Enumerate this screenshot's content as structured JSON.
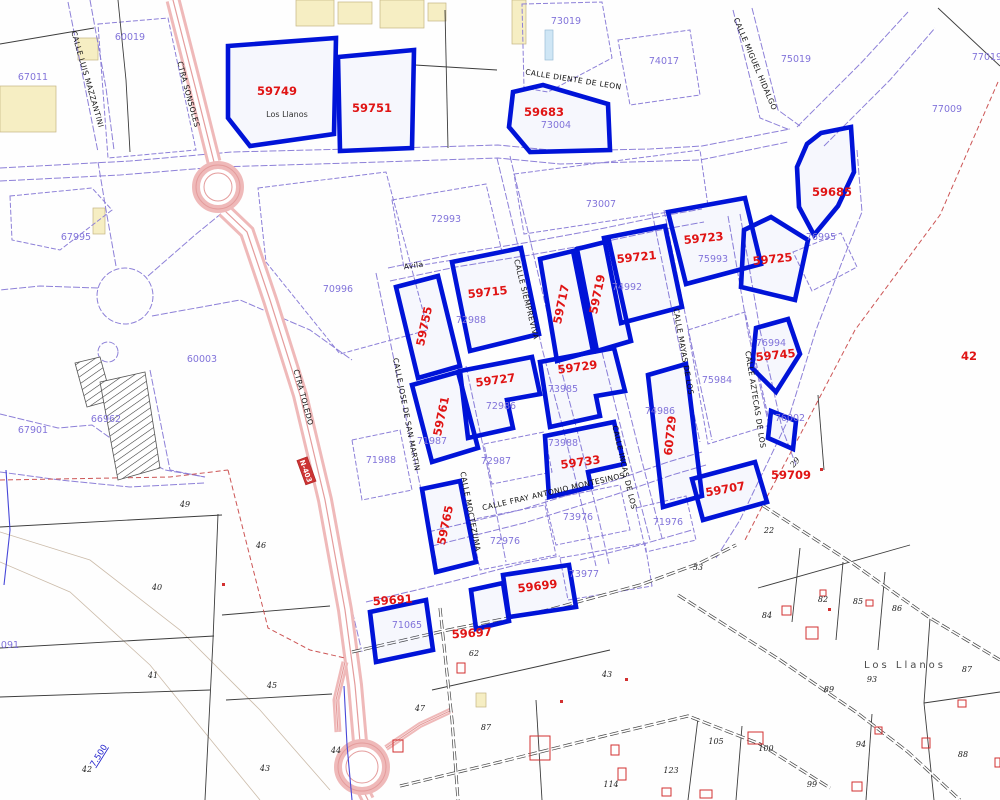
{
  "map": {
    "colors": {
      "highlight_blue": "#0013d8",
      "label_red": "#e01414",
      "parcel_purple": "#8274da",
      "road_pink": "#f0bcbc",
      "street_text": "#101010"
    },
    "parcels": [
      {
        "id": "59749",
        "lx": 277,
        "ly": 95,
        "rot": 0,
        "pts": "228,46 336,38 334,134 250,146 228,118"
      },
      {
        "id": "59751",
        "lx": 372,
        "ly": 112,
        "rot": 0,
        "pts": "338,57 414,50 412,148 340,151"
      },
      {
        "id": "59683",
        "lx": 544,
        "ly": 116,
        "rot": 0,
        "pts": "513,92 543,85 608,104 610,150 530,152 509,127"
      },
      {
        "id": "59685",
        "lx": 832,
        "ly": 196,
        "rot": 0,
        "pts": "821,133 851,127 854,172 838,206 814,235 799,207 797,167 807,144"
      },
      {
        "id": "59723",
        "lx": 704,
        "ly": 242,
        "rot": -6,
        "pts": "668,212 745,198 761,264 686,284"
      },
      {
        "id": "59721",
        "lx": 637,
        "ly": 261,
        "rot": -6,
        "pts": "604,238 665,226 682,307 621,323"
      },
      {
        "id": "59725",
        "lx": 773,
        "ly": 263,
        "rot": -6,
        "pts": "744,230 771,217 808,240 795,300 741,287"
      },
      {
        "id": "59715",
        "lx": 488,
        "ly": 296,
        "rot": -6,
        "pts": "452,262 521,248 539,334 470,351"
      },
      {
        "id": "59717",
        "lx": 565,
        "ly": 305,
        "rot": -78,
        "pts": "540,259 573,251 593,351 557,361"
      },
      {
        "id": "59719",
        "lx": 601,
        "ly": 295,
        "rot": -78,
        "pts": "577,249 609,241 631,341 597,351"
      },
      {
        "id": "59755",
        "lx": 428,
        "ly": 327,
        "rot": -78,
        "pts": "396,287 438,276 460,366 418,378"
      },
      {
        "id": "59761",
        "lx": 445,
        "ly": 417,
        "rot": -78,
        "pts": "412,385 458,372 478,448 432,462"
      },
      {
        "id": "59727",
        "lx": 496,
        "ly": 384,
        "rot": -8,
        "pts": "460,371 532,357 540,394 507,400 513,428 468,438"
      },
      {
        "id": "59729",
        "lx": 578,
        "ly": 371,
        "rot": -8,
        "pts": "540,362 614,348 625,391 596,396 600,416 550,427"
      },
      {
        "id": "59733",
        "lx": 581,
        "ly": 466,
        "rot": -8,
        "pts": "545,436 614,422 624,464 588,472 591,487 549,497"
      },
      {
        "id": "60729",
        "lx": 674,
        "ly": 436,
        "rot": -84,
        "pts": "648,375 686,364 702,496 663,507"
      },
      {
        "id": "59745",
        "lx": 776,
        "ly": 359,
        "rot": -6,
        "pts": "756,328 788,319 800,354 776,392 752,368"
      },
      {
        "id": "59709",
        "lx": 791,
        "ly": 479,
        "rot": 0,
        "pts": "771,411 796,421 793,449 768,438"
      },
      {
        "id": "59707",
        "lx": 726,
        "ly": 493,
        "rot": -10,
        "pts": "692,479 755,462 767,502 703,520"
      },
      {
        "id": "59765",
        "lx": 449,
        "ly": 526,
        "rot": -78,
        "pts": "422,489 460,481 476,562 436,572"
      },
      {
        "id": "59691",
        "lx": 393,
        "ly": 604,
        "rot": -4,
        "pts": "370,612 426,600 433,650 376,662"
      },
      {
        "id": "",
        "lx": 0,
        "ly": 0,
        "rot": 0,
        "pts": "471,590 503,583 509,621 476,629"
      },
      {
        "id": "59699",
        "lx": 538,
        "ly": 590,
        "rot": -7,
        "pts": "503,575 569,565 576,607 509,617"
      }
    ],
    "red_labels": [
      {
        "t": "59697",
        "x": 472,
        "y": 637,
        "r": -4
      },
      {
        "t": "42",
        "x": 969,
        "y": 360,
        "r": 0
      }
    ],
    "parcel_numbers": [
      {
        "t": "60019",
        "x": 130,
        "y": 40
      },
      {
        "t": "67011",
        "x": 33,
        "y": 80
      },
      {
        "t": "67995",
        "x": 76,
        "y": 240
      },
      {
        "t": "73019",
        "x": 566,
        "y": 24
      },
      {
        "t": "74017",
        "x": 664,
        "y": 64
      },
      {
        "t": "75019",
        "x": 796,
        "y": 62
      },
      {
        "t": "77019",
        "x": 987,
        "y": 60
      },
      {
        "t": "77009",
        "x": 947,
        "y": 112
      },
      {
        "t": "73004",
        "x": 556,
        "y": 128
      },
      {
        "t": "73007",
        "x": 601,
        "y": 207
      },
      {
        "t": "72993",
        "x": 446,
        "y": 222
      },
      {
        "t": "74992",
        "x": 627,
        "y": 290
      },
      {
        "t": "75993",
        "x": 713,
        "y": 262
      },
      {
        "t": "76995",
        "x": 821,
        "y": 240
      },
      {
        "t": "70996",
        "x": 338,
        "y": 292
      },
      {
        "t": "72988",
        "x": 471,
        "y": 323
      },
      {
        "t": "71987",
        "x": 432,
        "y": 444
      },
      {
        "t": "72986",
        "x": 501,
        "y": 409
      },
      {
        "t": "73985",
        "x": 563,
        "y": 392
      },
      {
        "t": "73988",
        "x": 563,
        "y": 446
      },
      {
        "t": "72987",
        "x": 496,
        "y": 464
      },
      {
        "t": "71988",
        "x": 381,
        "y": 463
      },
      {
        "t": "73976",
        "x": 578,
        "y": 520
      },
      {
        "t": "72976",
        "x": 505,
        "y": 544
      },
      {
        "t": "75984",
        "x": 717,
        "y": 383
      },
      {
        "t": "74986",
        "x": 660,
        "y": 414
      },
      {
        "t": "76994",
        "x": 771,
        "y": 346
      },
      {
        "t": "76002",
        "x": 790,
        "y": 421
      },
      {
        "t": "71976",
        "x": 668,
        "y": 525
      },
      {
        "t": "73977",
        "x": 584,
        "y": 577
      },
      {
        "t": "71065",
        "x": 407,
        "y": 628
      },
      {
        "t": "67901",
        "x": 33,
        "y": 433
      },
      {
        "t": "66962",
        "x": 106,
        "y": 422
      },
      {
        "t": "60003",
        "x": 202,
        "y": 362
      },
      {
        "t": "091",
        "x": 10,
        "y": 648
      }
    ],
    "rural_numbers": [
      {
        "t": "49",
        "x": 185,
        "y": 507
      },
      {
        "t": "40",
        "x": 157,
        "y": 590
      },
      {
        "t": "41",
        "x": 153,
        "y": 678
      },
      {
        "t": "42",
        "x": 87,
        "y": 772
      },
      {
        "t": "43",
        "x": 265,
        "y": 771
      },
      {
        "t": "45",
        "x": 272,
        "y": 688
      },
      {
        "t": "46",
        "x": 261,
        "y": 548
      },
      {
        "t": "44",
        "x": 336,
        "y": 753
      },
      {
        "t": "47",
        "x": 420,
        "y": 711
      },
      {
        "t": "43",
        "x": 607,
        "y": 677
      },
      {
        "t": "87",
        "x": 486,
        "y": 730
      },
      {
        "t": "62",
        "x": 474,
        "y": 656
      },
      {
        "t": "22",
        "x": 769,
        "y": 533
      },
      {
        "t": "53",
        "x": 698,
        "y": 570
      },
      {
        "t": "84",
        "x": 767,
        "y": 618
      },
      {
        "t": "82",
        "x": 823,
        "y": 602
      },
      {
        "t": "85",
        "x": 858,
        "y": 604
      },
      {
        "t": "86",
        "x": 897,
        "y": 611
      },
      {
        "t": "87",
        "x": 967,
        "y": 672
      },
      {
        "t": "93",
        "x": 872,
        "y": 682
      },
      {
        "t": "89",
        "x": 829,
        "y": 692
      },
      {
        "t": "94",
        "x": 861,
        "y": 747
      },
      {
        "t": "88",
        "x": 963,
        "y": 757
      },
      {
        "t": "105",
        "x": 716,
        "y": 744
      },
      {
        "t": "100",
        "x": 766,
        "y": 751
      },
      {
        "t": "114",
        "x": 611,
        "y": 787
      },
      {
        "t": "123",
        "x": 671,
        "y": 773
      },
      {
        "t": "99",
        "x": 812,
        "y": 787
      },
      {
        "t": "29",
        "x": 797,
        "y": 464,
        "r": -50
      }
    ],
    "street_names": [
      {
        "t": "CALLE LUIS MAZZANTINI",
        "x": 85,
        "y": 80,
        "r": 74
      },
      {
        "t": "CTRA SONSOLES",
        "x": 186,
        "y": 95,
        "r": 75
      },
      {
        "t": "CTRA TOLEDO",
        "x": 301,
        "y": 398,
        "r": 75
      },
      {
        "t": "CALLE MIGUEL HIDALGO",
        "x": 753,
        "y": 65,
        "r": 67
      },
      {
        "t": "CALLE DIENTE DE LEON",
        "x": 573,
        "y": 82,
        "r": 9
      },
      {
        "t": "Avila",
        "x": 414,
        "y": 268,
        "r": -8
      },
      {
        "t": "CALLE SIEMPREVIVA",
        "x": 524,
        "y": 300,
        "r": 76
      },
      {
        "t": "CALLE JOSE DE SAN MARTIN",
        "x": 404,
        "y": 415,
        "r": 79
      },
      {
        "t": "CALLE MOCTEZUMA",
        "x": 468,
        "y": 512,
        "r": 79
      },
      {
        "t": "CALLE FRAY ANTONIO MONTESINOS",
        "x": 554,
        "y": 494,
        "r": -13
      },
      {
        "t": "CALLE MAYAS DE LOS",
        "x": 681,
        "y": 352,
        "r": 80
      },
      {
        "t": "CALLE INCAS DE LOS",
        "x": 622,
        "y": 468,
        "r": 77
      },
      {
        "t": "CALLE AZTECAS DE LOS",
        "x": 753,
        "y": 400,
        "r": 81
      }
    ],
    "place_labels": [
      {
        "t": "Los Llanos",
        "x": 287,
        "y": 117,
        "cls": "t-place-sm"
      },
      {
        "t": "Los Llanos",
        "x": 905,
        "y": 668,
        "cls": "t-place-lg"
      }
    ],
    "road_shield": {
      "label": "N-403",
      "x": 306,
      "y": 471,
      "r": 70
    },
    "km_marker": {
      "label": "7.500",
      "x": 101,
      "y": 757,
      "r": -58
    },
    "roads_pink": [
      {
        "w": 15,
        "pts": "173,0 196,90 214,162"
      },
      {
        "w": 16,
        "pts": "224,210 247,232 270,300 300,395 325,500 345,610 355,685 360,742"
      },
      {
        "w": 14,
        "pts": "363,790 368,800"
      },
      {
        "w": 7,
        "pts": "345,662 336,700 338,732"
      },
      {
        "w": 6,
        "pts": "386,748 420,725 452,710"
      }
    ],
    "roundabouts": [
      {
        "cx": 218,
        "cy": 187,
        "r": 22
      },
      {
        "cx": 362,
        "cy": 767,
        "r": 24
      }
    ],
    "violet_circles": [
      {
        "cx": 125,
        "cy": 296,
        "r": 28
      },
      {
        "cx": 108,
        "cy": 352,
        "r": 10
      }
    ],
    "violet_lines": [
      "0,168 130,161 232,152 350,149 432,147 498,145 560,151 650,149 702,146 790,129",
      "0,181 120,175 218,167 350,163 498,158 560,164 700,160 788,142",
      "733,10 760,118 790,130",
      "752,8 778,110 800,126",
      "797,127 862,62 908,12",
      "824,146 890,80 935,28",
      "857,150 862,212 842,262 816,330 788,420 764,470 740,520 716,558",
      "388,268 455,254 530,242 600,229 662,216 702,209",
      "390,281 456,267 530,255 598,243 660,230 704,222",
      "497,158 519,250 543,352 564,432 586,522 596,566",
      "510,156 532,248 556,350 577,430 599,520 609,564",
      "376,273 394,360 416,466 436,560",
      "466,366 486,460 506,562",
      "428,532 520,510 610,482 668,462 702,452",
      "432,546 524,523 614,495 672,475 706,465",
      "366,602 450,582 520,564 560,556",
      "580,560 640,545 692,530",
      "652,212 676,330 700,442",
      "664,210 688,328 712,440",
      "602,352 626,448 650,540",
      "614,350 638,446 662,538",
      "740,214 760,330 782,428 796,465",
      "728,216 748,332 770,430",
      "68,2 86,92 98,152",
      "90,0 106,88 114,150",
      "148,276 195,235 228,208",
      "152,316 240,300 310,330 352,360",
      "98,288 40,286 0,290",
      "116,266 106,210 98,162",
      "255,238 282,330 305,400 330,505 352,610 362,652",
      "0,414 58,428 92,425 130,452 165,470 205,477",
      "0,472 60,480 130,487 205,483",
      "150,370 162,430 170,470 205,477"
    ],
    "violet_blocks": [
      "98,24 168,18 196,150 108,158",
      "392,200 486,184 502,252 404,268",
      "514,174 700,150 708,206 524,234",
      "258,188 386,172 428,330 340,354 266,262",
      "688,330 745,312 770,425 708,444",
      "793,252 841,233 857,267 812,291",
      "484,444 544,432 552,472 492,484",
      "470,520 545,505 556,555 480,570",
      "545,500 620,485 630,530 556,545",
      "560,558 645,543 652,586 568,600",
      "352,440 400,430 412,490 362,500",
      "636,508 686,496 696,540 646,552",
      "522,4 602,2 612,58 548,92 524,88",
      "618,40 690,30 700,95 630,105",
      "10,196 92,188 112,210 60,250 12,240"
    ],
    "black_lines": [
      "0,527 222,515",
      "0,648 214,636",
      "0,697 210,690",
      "218,514 213,640 205,800",
      "222,615 330,606",
      "226,700 332,694",
      "118,0 126,80 130,152",
      "0,44 94,28",
      "415,65 497,70",
      "445,10 448,148",
      "938,8 1000,66",
      "818,395 824,470",
      "758,588 910,545",
      "800,548 792,622",
      "843,562 836,640",
      "885,572 878,650",
      "930,618 924,703 934,800",
      "698,718 688,800",
      "742,726 736,800",
      "872,714 866,800",
      "432,690 540,666 610,650",
      "536,700 542,800",
      "924,703 1000,692"
    ],
    "black_double_tracks": [
      "352,652 448,630 548,610 640,585 700,563 736,545",
      "762,505 855,565 930,618 1000,660",
      "678,595 780,660 856,712 908,752 960,800",
      "400,786 500,762 600,737 688,716 760,744 830,788",
      "440,608 452,720 458,800"
    ],
    "red_dash_lines": [
      "998,82 940,215 855,330 800,435 768,495 745,540",
      "0,480 170,477 228,470",
      "228,470 268,628 310,650 345,658"
    ],
    "gray_contours": [
      "0,532 90,560 180,630 260,710 330,790",
      "0,562 70,592 150,665 215,745 260,800"
    ],
    "blue_streams": [
      "6,470 10,530 4,585",
      "344,686 347,745 352,800"
    ],
    "yellow_buildings": [
      [
        0,
        86,
        56,
        46
      ],
      [
        78,
        38,
        20,
        22
      ],
      [
        296,
        0,
        38,
        26
      ],
      [
        338,
        2,
        34,
        22
      ],
      [
        380,
        0,
        44,
        28
      ],
      [
        428,
        3,
        18,
        18
      ],
      [
        512,
        0,
        14,
        44
      ],
      [
        93,
        208,
        12,
        26
      ],
      [
        476,
        693,
        10,
        14
      ]
    ],
    "cyan_buildings": [
      [
        545,
        30,
        8,
        30
      ]
    ],
    "red_buildings": [
      [
        530,
        736,
        20,
        24
      ],
      [
        611,
        745,
        8,
        10
      ],
      [
        748,
        732,
        15,
        12
      ],
      [
        806,
        627,
        12,
        12
      ],
      [
        782,
        606,
        9,
        9
      ],
      [
        875,
        727,
        7,
        7
      ],
      [
        922,
        738,
        8,
        10
      ],
      [
        958,
        700,
        8,
        7
      ],
      [
        995,
        758,
        5,
        9
      ],
      [
        852,
        782,
        10,
        9
      ],
      [
        662,
        788,
        9,
        8
      ],
      [
        618,
        768,
        8,
        12
      ],
      [
        457,
        663,
        8,
        10
      ],
      [
        393,
        740,
        10,
        12
      ],
      [
        700,
        790,
        12,
        8
      ],
      [
        820,
        590,
        6,
        6
      ],
      [
        866,
        600,
        7,
        6
      ]
    ],
    "red_dots": [
      [
        828,
        608
      ],
      [
        222,
        583
      ],
      [
        820,
        468
      ],
      [
        625,
        678
      ],
      [
        560,
        700
      ]
    ],
    "hatch_areas": [
      "75,363 100,357 112,400 87,407",
      "100,382 145,372 160,468 118,480"
    ]
  }
}
